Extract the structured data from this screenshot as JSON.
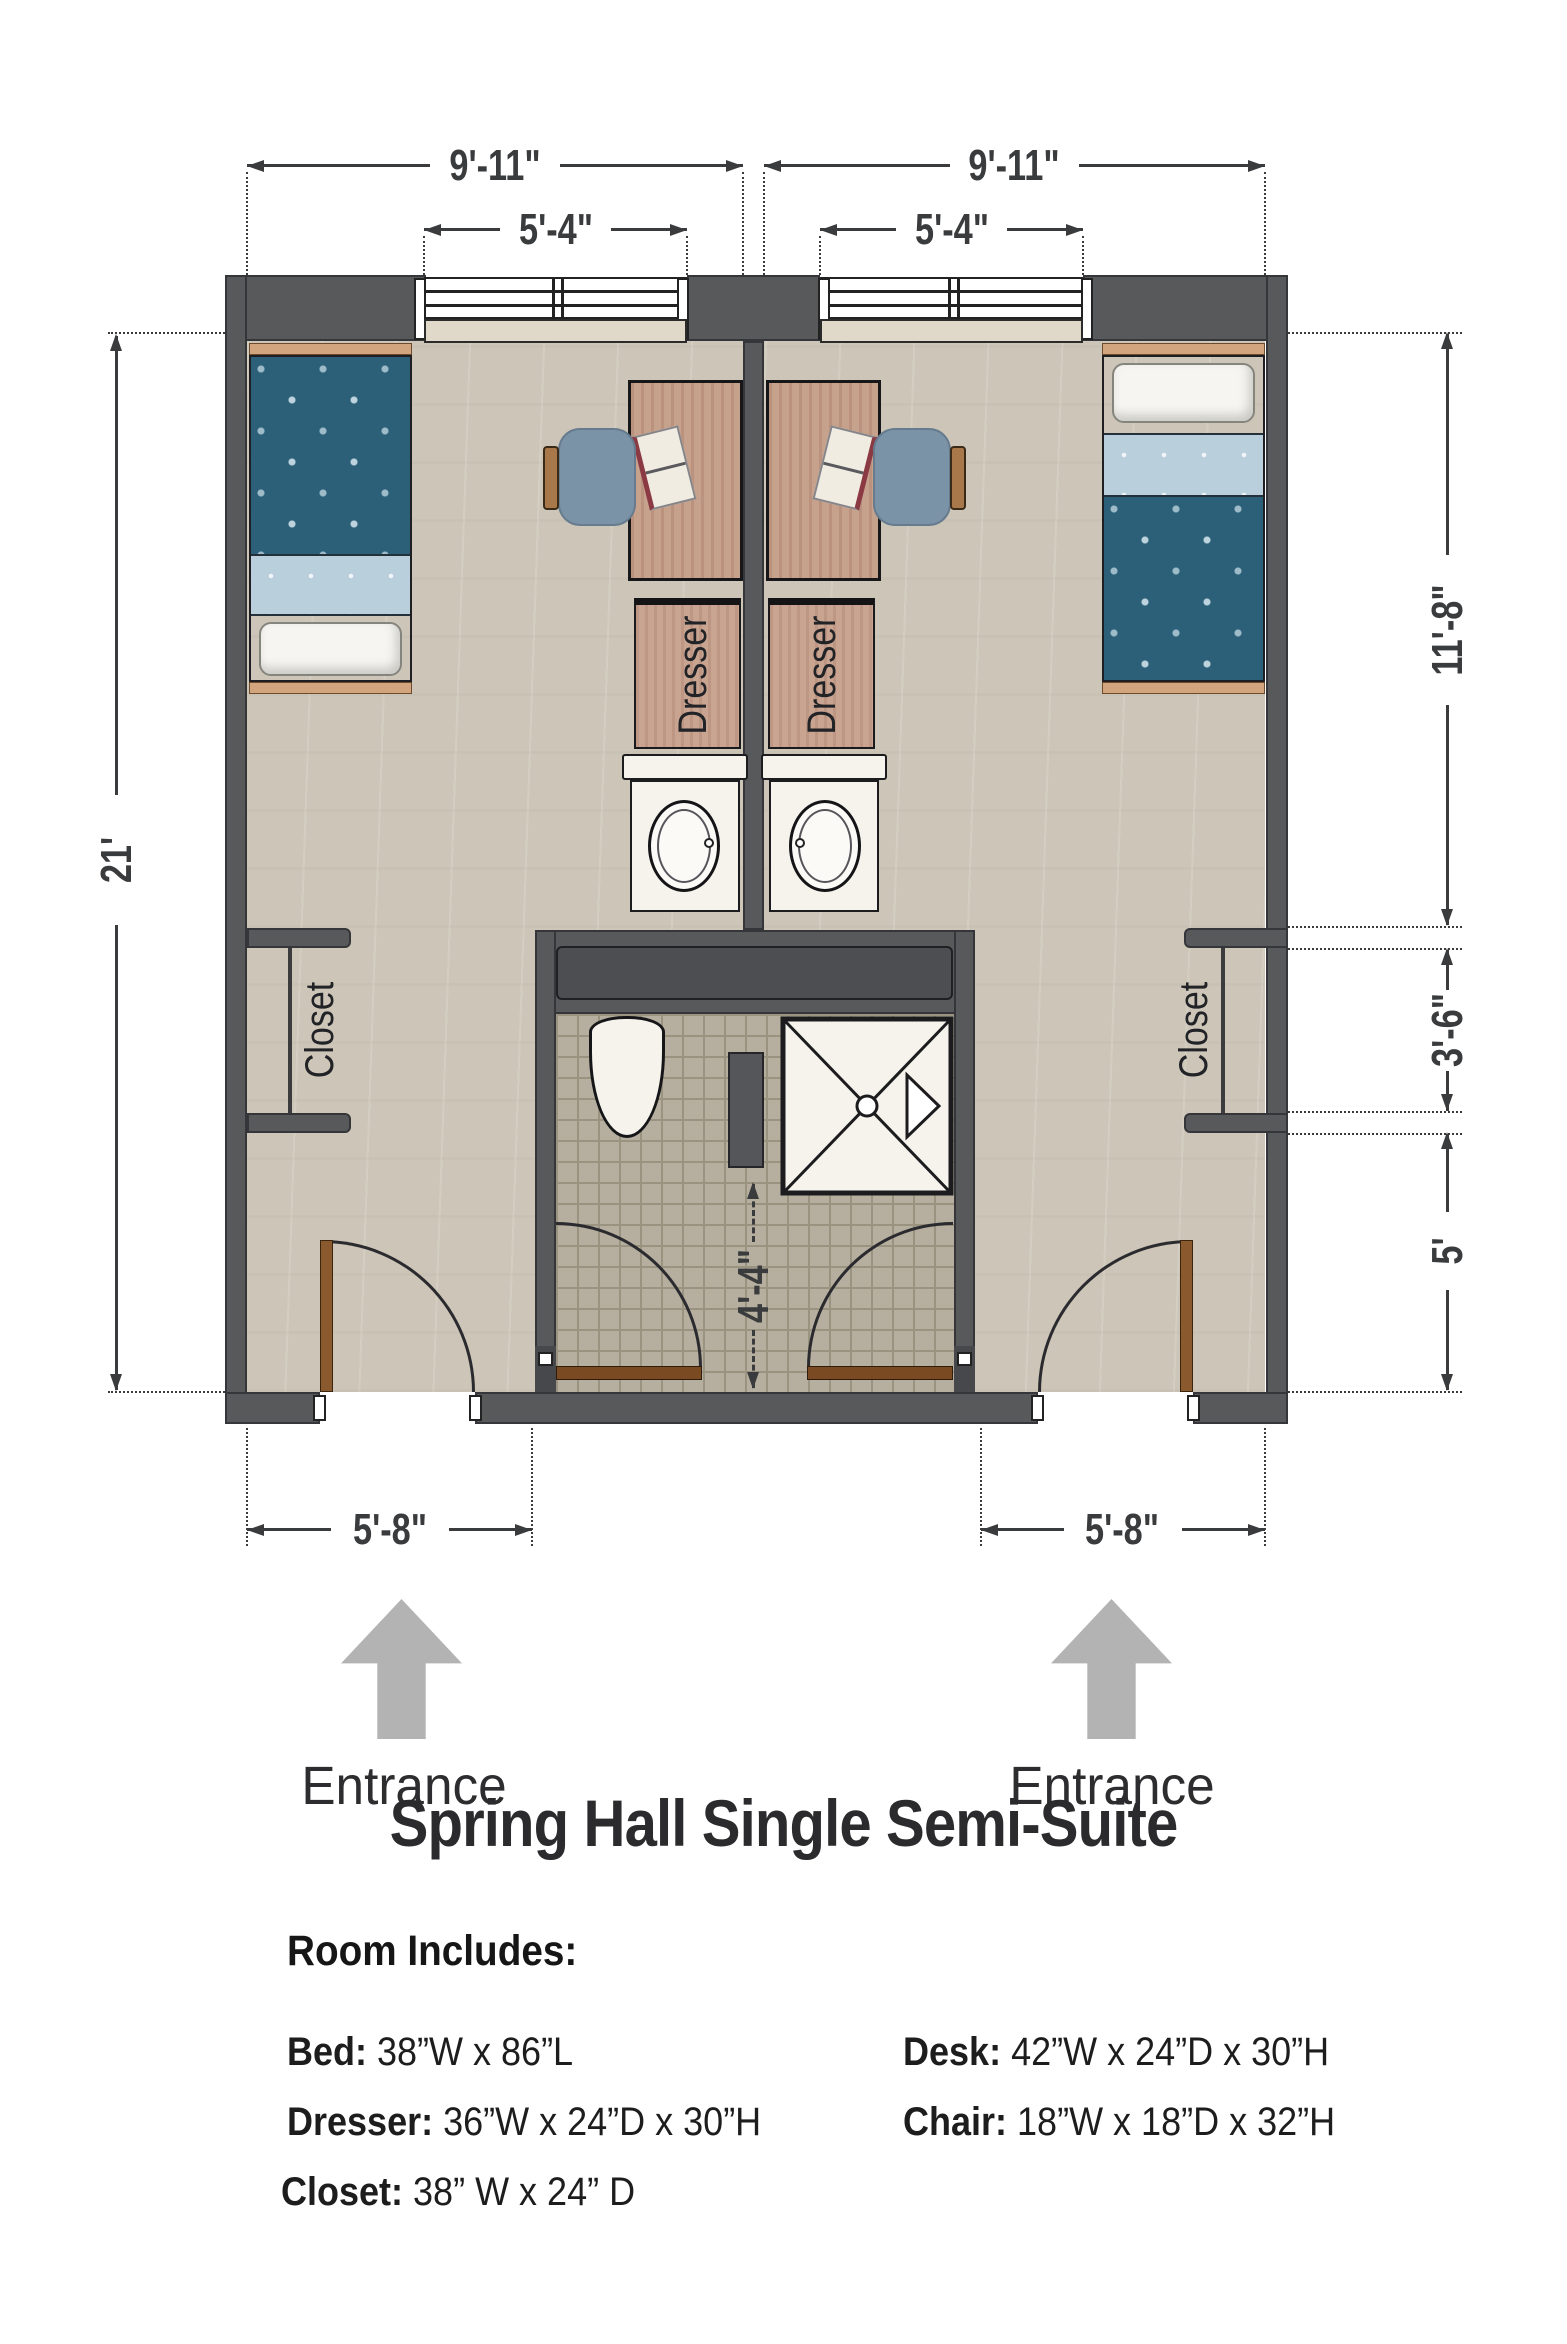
{
  "title": "Spring Hall Single Semi-Suite",
  "plan": {
    "dimensions": {
      "room_left_width": "9'-11\"",
      "room_right_width": "9'-11\"",
      "window_left": "5'-4\"",
      "window_right": "5'-4\"",
      "overall_height": "21'",
      "right_upper": "11'-8\"",
      "right_middle": "3'-6\"",
      "right_lower": "5'",
      "bath_corridor": "4'-4\"",
      "entry_left": "5'-8\"",
      "entry_right": "5'-8\""
    },
    "labels": {
      "dresser_left": "Dresser",
      "dresser_right": "Dresser",
      "closet_left": "Closet",
      "closet_right": "Closet",
      "entrance_left": "Entrance",
      "entrance_right": "Entrance"
    }
  },
  "room_includes": {
    "heading": "Room Includes:",
    "items_left": [
      {
        "label": "Bed:",
        "value": "38”W x 86”L"
      },
      {
        "label": "Dresser:",
        "value": "36”W x 24”D x 30”H"
      },
      {
        "label": "Closet:",
        "value": "38” W x 24” D"
      }
    ],
    "items_right": [
      {
        "label": "Desk:",
        "value": "42”W x 24”D x 30”H"
      },
      {
        "label": "Chair:",
        "value": "18”W x 18”D x 32”H"
      }
    ]
  },
  "colors": {
    "wall": "#58595b",
    "wall_outline": "#35363a",
    "floor": "#cdc6b8",
    "tile": "#b6afa0",
    "tile_grout": "#9a9380",
    "bedspread_teal": "#2c6078",
    "bedspread_fold": "#b9cfdc",
    "wood_light": "#d2a57e",
    "wood_desk": "#c6a18c",
    "wood_dresser": "#c9a491",
    "chair_blue": "#7b93a6",
    "chair_wood": "#a8774a",
    "door_brown": "#8a5a2e",
    "bath_door_brown": "#7a4a22",
    "fixture_white": "#f6f3ed",
    "arrow_gray": "#b3b3b3",
    "dim": "#3a3b3d",
    "text_color": "#2d2d2f"
  }
}
